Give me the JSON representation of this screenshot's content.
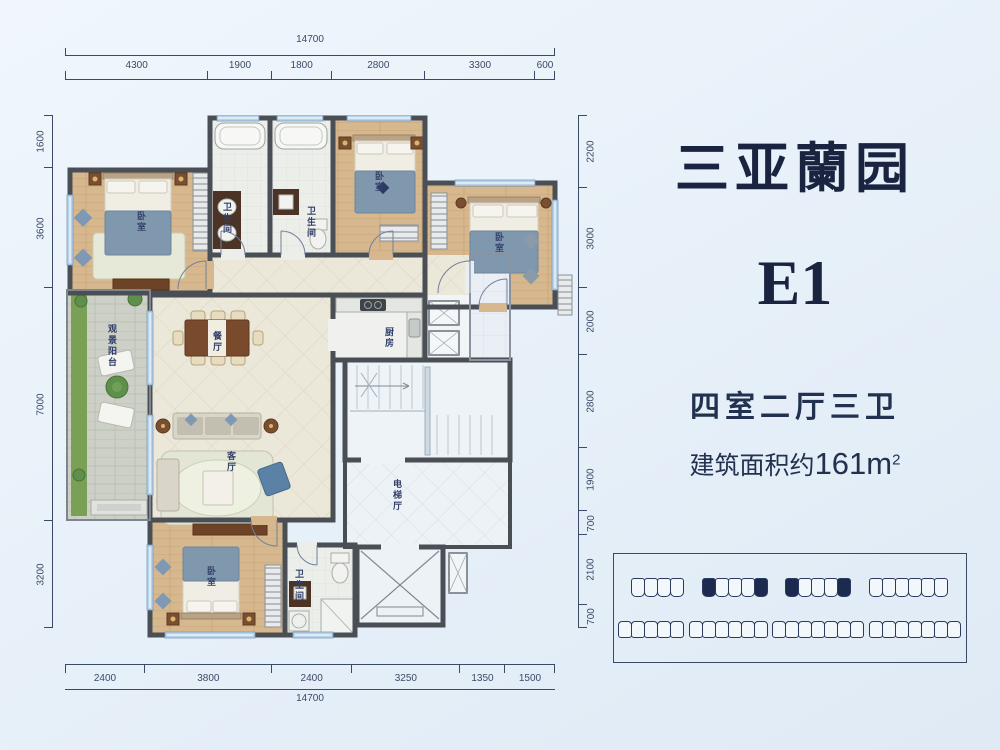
{
  "title_block": {
    "project_name": "三亚蘭园",
    "unit_code": "E1",
    "layout_spec": "四室二厅三卫",
    "area_prefix": "建筑面积约",
    "area_value": "161m",
    "area_sup": "2"
  },
  "dimensions": {
    "top": {
      "total": "14700",
      "segments": [
        "4300",
        "1900",
        "1800",
        "2800",
        "3300",
        "600"
      ]
    },
    "bottom": {
      "total": "14700",
      "segments": [
        "2400",
        "3800",
        "2400",
        "3250",
        "1350",
        "1500"
      ]
    },
    "left": {
      "segments": [
        "1600",
        "3600",
        "7000",
        "3200"
      ]
    },
    "right": {
      "segments": [
        "2200",
        "3000",
        "2000",
        "2800",
        "1900",
        "700",
        "2100",
        "700"
      ]
    }
  },
  "rooms": [
    {
      "id": "master-bedroom",
      "label": "卧室"
    },
    {
      "id": "master-bath",
      "label": "卫生间"
    },
    {
      "id": "bath-2",
      "label": "卫生间"
    },
    {
      "id": "bedroom-2",
      "label": "卧室"
    },
    {
      "id": "bedroom-3",
      "label": "卧室"
    },
    {
      "id": "kitchen",
      "label": "厨房"
    },
    {
      "id": "dining-room",
      "label": "餐厅"
    },
    {
      "id": "living-room",
      "label": "客厅"
    },
    {
      "id": "balcony",
      "label": "观景阳台"
    },
    {
      "id": "elevator-hall",
      "label": "电梯厅"
    },
    {
      "id": "bedroom-4",
      "label": "卧室"
    },
    {
      "id": "bath-3",
      "label": "卫生间"
    }
  ],
  "key_plan": {
    "rows": [
      [
        {
          "units": 4,
          "highlight_ends": false
        },
        {
          "units": 5,
          "highlight_ends": true
        },
        {
          "units": 5,
          "highlight_ends": true
        },
        {
          "units": 6,
          "highlight_ends": false
        }
      ],
      [
        {
          "units": 5,
          "highlight_ends": false
        },
        {
          "units": 6,
          "highlight_ends": false
        },
        {
          "units": 7,
          "highlight_ends": false
        },
        {
          "units": 7,
          "highlight_ends": false
        }
      ]
    ]
  },
  "colors": {
    "navy": "#1a2340",
    "dim": "#3a4a66",
    "wall": "#4a4f55",
    "highlight": "#1c2a50",
    "wood": "#d7b88e",
    "blanket": "#8098ad",
    "grass": "#7aa055"
  }
}
